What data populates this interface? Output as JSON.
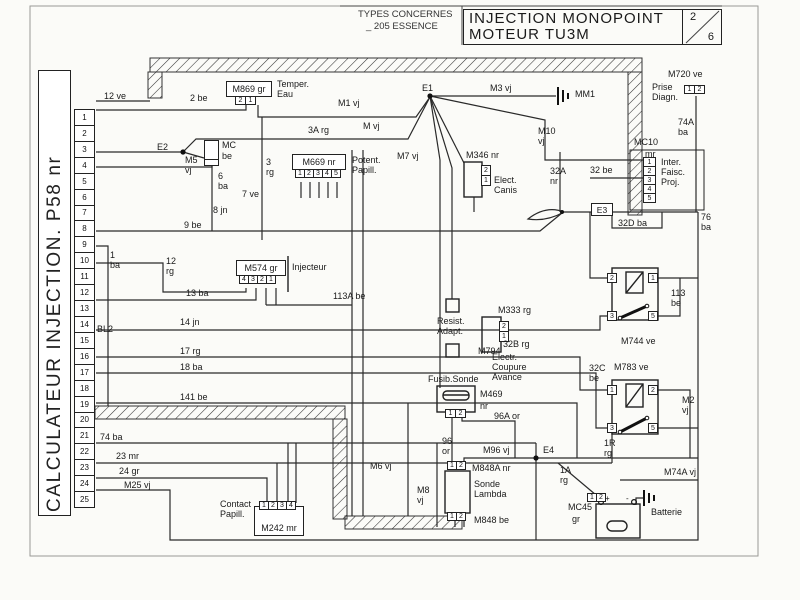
{
  "header": {
    "types_label": "TYPES CONCERNES",
    "types_value": "_ 205 ESSENCE",
    "title_line1": "INJECTION MONOPOINT",
    "title_line2": "MOTEUR TU3M",
    "page_num": "2",
    "page_total": "6"
  },
  "calculateur": {
    "label": "CALCULATEUR  INJECTION. P58 nr",
    "pins": [
      "1",
      "2",
      "3",
      "4",
      "5",
      "6",
      "7",
      "8",
      "9",
      "10",
      "11",
      "12",
      "13",
      "14",
      "15",
      "16",
      "17",
      "18",
      "19",
      "20",
      "21",
      "22",
      "23",
      "24",
      "25"
    ]
  },
  "nodes": {
    "e1": "E1",
    "e2": "E2",
    "e3": "E3",
    "e4": "E4"
  },
  "grounds": {
    "mm1": "MM1"
  },
  "wires": {
    "v12ve": "12 ve",
    "v2be": "2 be",
    "m1vj": "M1 vj",
    "m3vj": "M3 vj",
    "mvj": "M vj",
    "v3arg": "3A rg",
    "m10vj": "M10 vj",
    "m7vj": "M7 vj",
    "m720ve": "M720 ve",
    "v74aba": "74A ba",
    "m5vj": "M5 vj",
    "v6ba": "6 ba",
    "v3rg": "3 rg",
    "v7ve": "7 ve",
    "v8jn": "8 jn",
    "v9be": "9 be",
    "v32anr": "32A nr",
    "v32be": "32 be",
    "v32dba": "32D ba",
    "v76ba": "76 ba",
    "v1ba": "1 ba",
    "v12rg": "12 rg",
    "v13ba": "13 ba",
    "v113abe": "113A be",
    "v14jn": "14 jn",
    "bl2": "BL2",
    "v17rg": "17 rg",
    "v18ba": "18 ba",
    "v141be": "141 be",
    "v113be": "113 be",
    "v32brg": "32B rg",
    "v32cbe": "32C be",
    "m2vj": "M2 vj",
    "v1rrg": "1R rg",
    "v96aor": "96A or",
    "v96or": "96 or",
    "m96vj": "M96 vj",
    "m6vj": "M6 vj",
    "m8vj": "M8 vj",
    "v1arg": "1A rg",
    "m74avj": "M74A vj",
    "v74ba": "74 ba",
    "v23mr": "23 mr",
    "v24gr": "24 gr",
    "m25vj": "M25 vj"
  },
  "components": {
    "temper_eau": {
      "ref": "M869 gr",
      "pins": [
        "2",
        "1"
      ],
      "label": [
        "Temper.",
        "Eau"
      ]
    },
    "prise_diagn": {
      "ref": "M720 ve",
      "pins": [
        "1",
        "2"
      ],
      "label": [
        "Prise",
        "Diagn."
      ]
    },
    "inter_faisc": {
      "ref": "MC10",
      "color": "mr",
      "pins": [
        "1",
        "2",
        "3",
        "4",
        "5"
      ],
      "label": [
        "Inter.",
        "Faisc.",
        "Proj."
      ]
    },
    "mc_conn": {
      "ref": "MC",
      "color": "be"
    },
    "potent_papill": {
      "ref": "M669 nr",
      "pins": [
        "1",
        "2",
        "3",
        "4",
        "5"
      ],
      "label": [
        "Potent.",
        "Papill."
      ]
    },
    "elect_canis": {
      "ref": "M346 nr",
      "pins": [
        "2",
        "1"
      ],
      "label": [
        "Elect.",
        "Canis"
      ]
    },
    "injecteur": {
      "ref": "M574 gr",
      "pins": [
        "4",
        "3",
        "2",
        "1"
      ],
      "label": "Injecteur"
    },
    "resist_adapt": {
      "ref": "M794",
      "label": [
        "Resist.",
        "Adapt."
      ]
    },
    "coupure_avance": {
      "ref": "M333 rg",
      "label": [
        "Electr.",
        "Coupure",
        "Avance"
      ]
    },
    "relay_pompe": {
      "ref": "M744 ve",
      "pins": [
        "2",
        "1",
        "3",
        "5"
      ]
    },
    "relay_inj": {
      "ref": "M783 ve",
      "pins": [
        "1",
        "2",
        "3",
        "5"
      ]
    },
    "fusib_sonde": {
      "title": "Fusib.Sonde",
      "ref": "M469",
      "color": "nr",
      "pins": [
        "1",
        "2"
      ]
    },
    "sonde_lambda": {
      "ref_top": "M848A nr",
      "pins_top": [
        "1",
        "2"
      ],
      "label": [
        "Sonde",
        "Lambda"
      ],
      "ref_bot": "M848 be",
      "pins_bot": [
        "1",
        "2"
      ]
    },
    "contact_papill": {
      "ref": "M242 mr",
      "pins": [
        "1",
        "2",
        "3",
        "4"
      ],
      "label": [
        "Contact",
        "Papill."
      ]
    },
    "batterie": {
      "ref": "MC45",
      "color": "gr",
      "pins": [
        "1",
        "2"
      ],
      "label": "Batterie",
      "plus": "+",
      "minus": "-"
    }
  }
}
